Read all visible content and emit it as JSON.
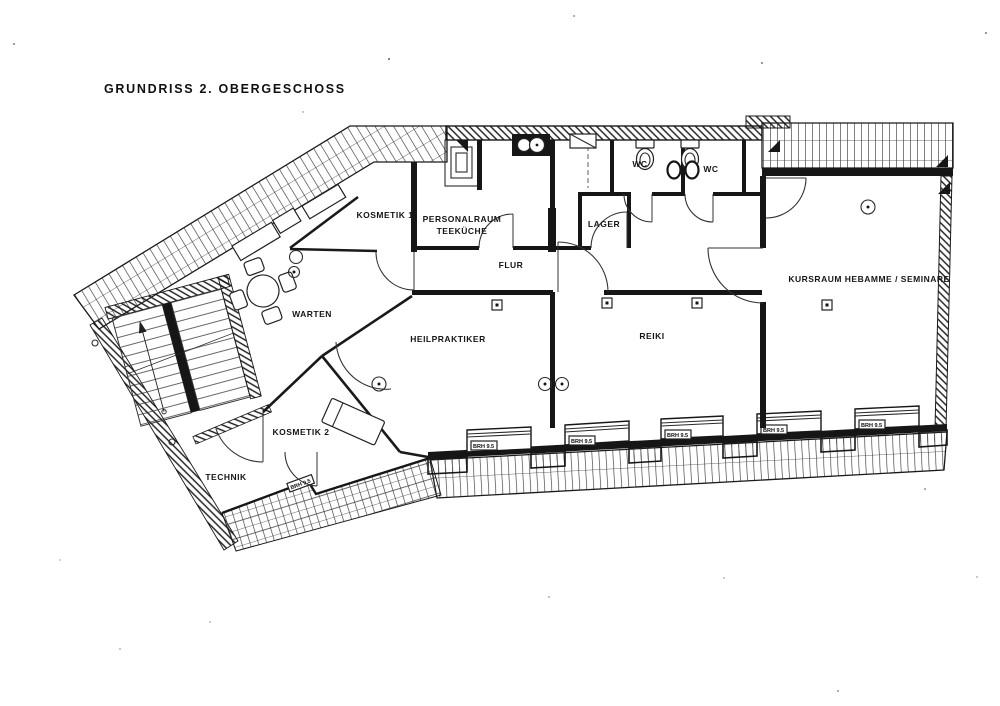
{
  "title": "GRUNDRISS 2. OBERGESCHOSS",
  "rooms": {
    "kosmetik1": "KOSMETIK 1",
    "personalraum_line1": "PERSONALRAUM",
    "personalraum_line2": "TEEKÜCHE",
    "wc_left": "WC",
    "wc_right": "WC",
    "lager": "LAGER",
    "flur": "FLUR",
    "warten": "WARTEN",
    "heilpraktiker": "HEILPRAKTIKER",
    "reiki": "REIKI",
    "kursraum": "KURSRAUM HEBAMME / SEMINARE",
    "kosmetik2": "KOSMETIK 2",
    "technik": "TECHNIK"
  },
  "annotations": {
    "window_label": "BRH 9.5",
    "window_label_count": 6
  },
  "colors": {
    "ink": "#161616",
    "paper": "#ffffff"
  }
}
